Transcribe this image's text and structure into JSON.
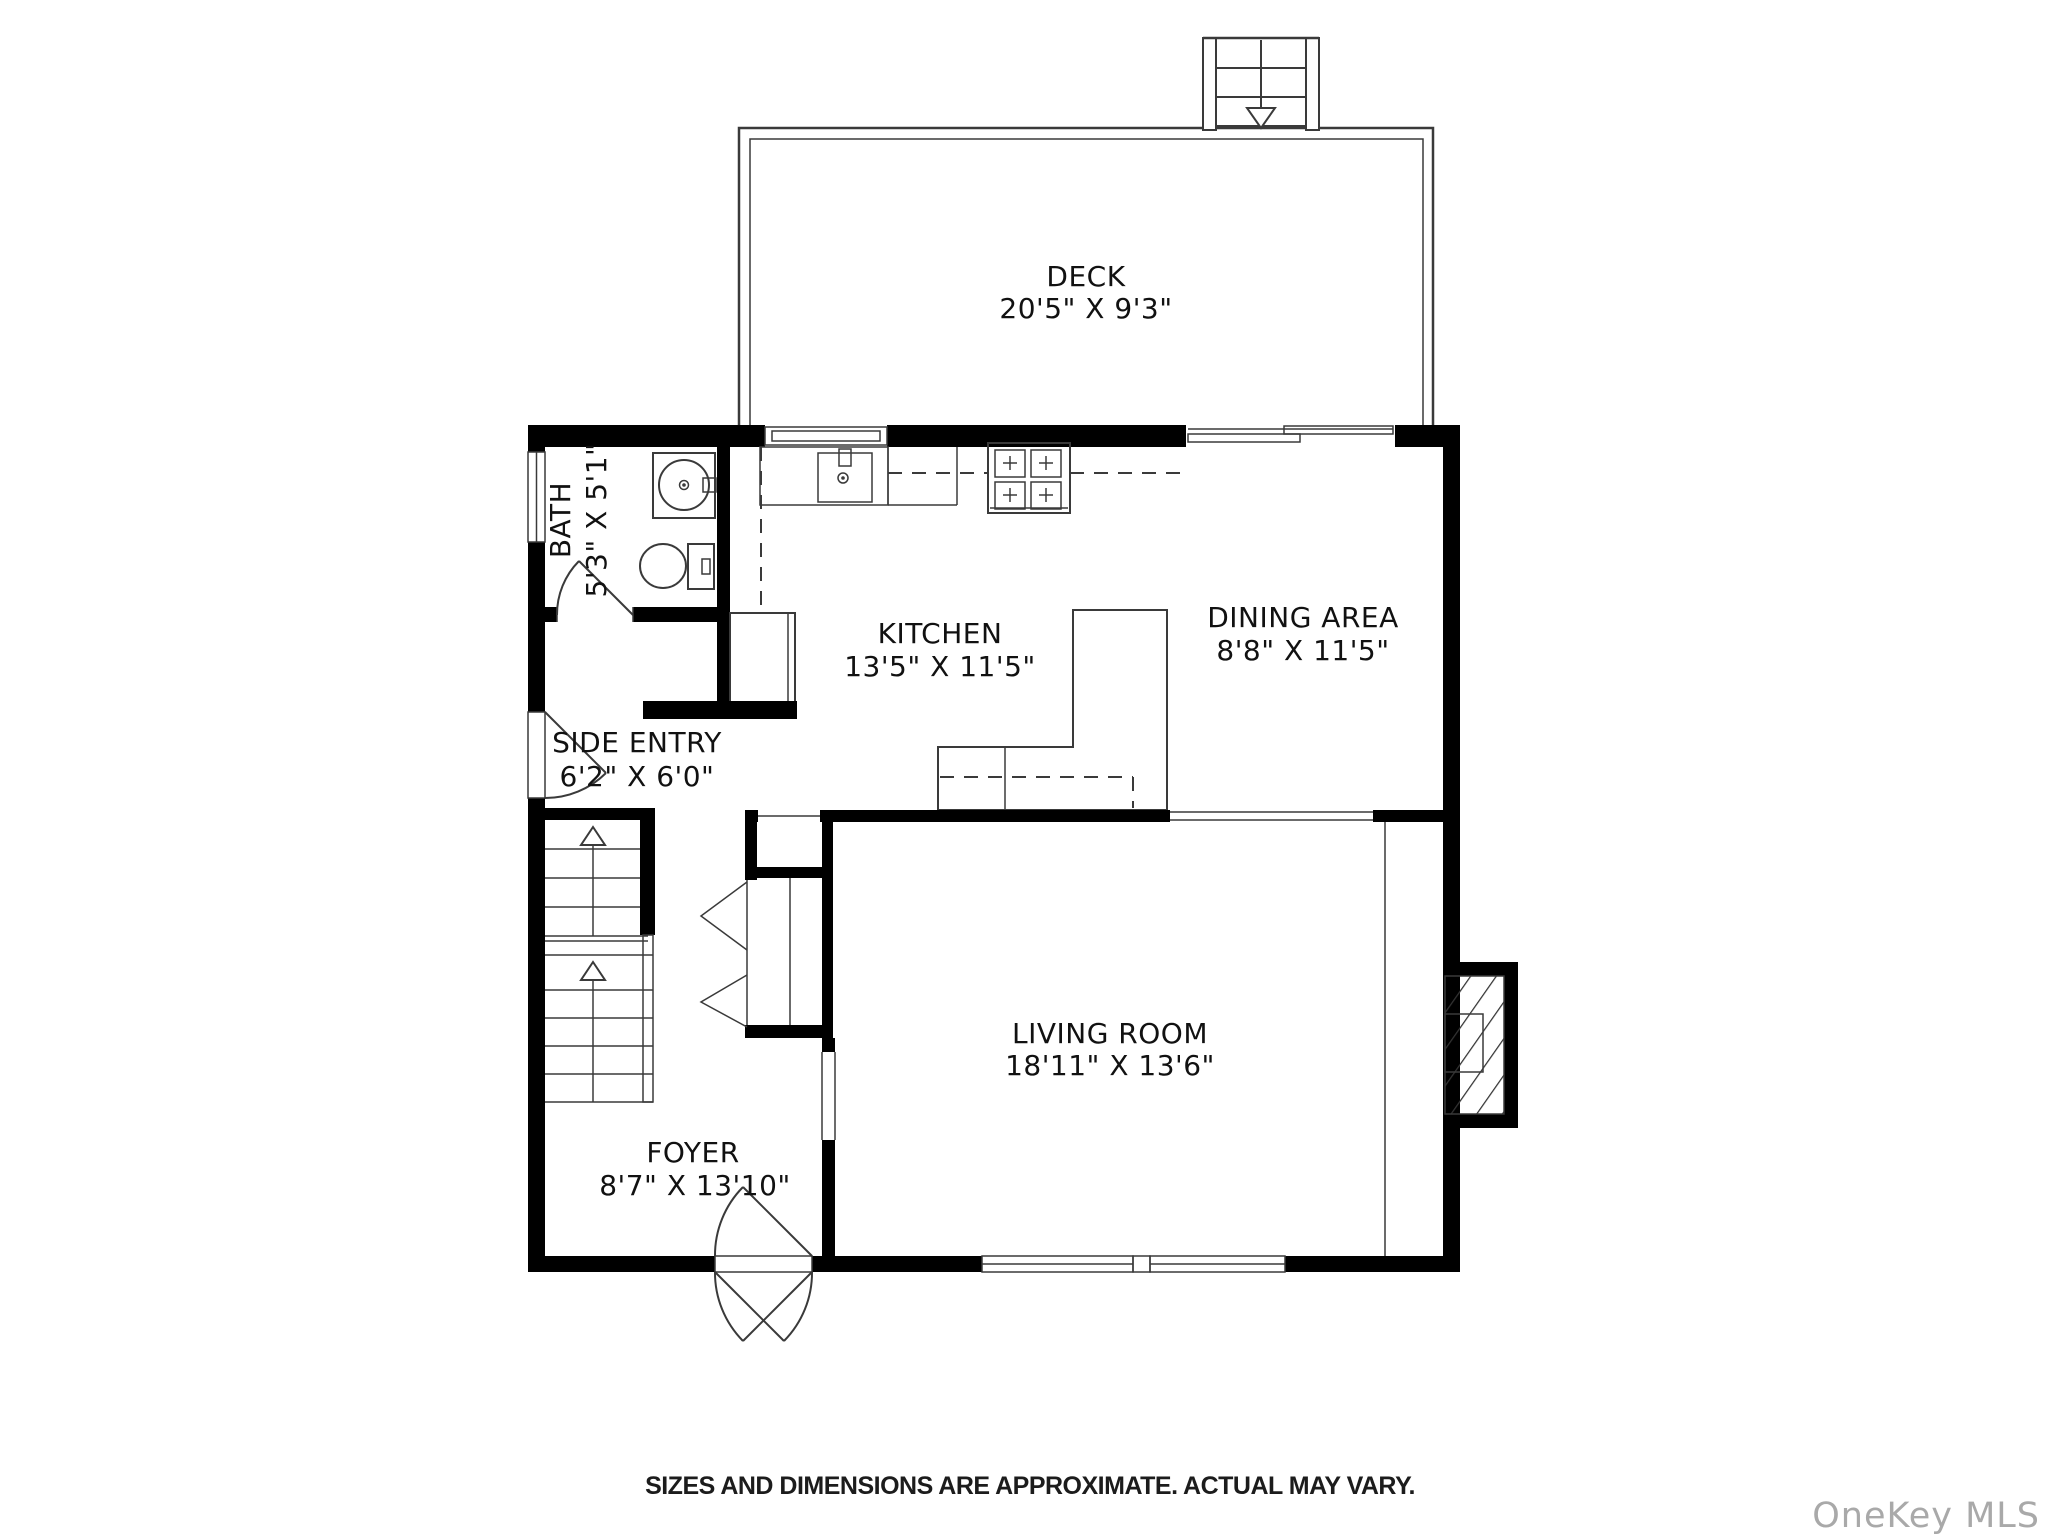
{
  "plan": {
    "rooms": [
      {
        "id": "deck",
        "name": "DECK",
        "dims": "20'5\" X 9'3\""
      },
      {
        "id": "bath",
        "name": "BATH",
        "dims": "5'3\" X 5'1\""
      },
      {
        "id": "kitchen",
        "name": "KITCHEN",
        "dims": "13'5\" X 11'5\""
      },
      {
        "id": "dining-area",
        "name": "DINING AREA",
        "dims": "8'8\" X 11'5\""
      },
      {
        "id": "side-entry",
        "name": "SIDE ENTRY",
        "dims": "6'2\" X 6'0\""
      },
      {
        "id": "living-room",
        "name": "LIVING ROOM",
        "dims": "18'11\" X 13'6\""
      },
      {
        "id": "foyer",
        "name": "FOYER",
        "dims": "8'7\" X 13'10\""
      }
    ],
    "footer": {
      "disclaimer": "SIZES AND DIMENSIONS ARE APPROXIMATE. ACTUAL MAY VARY."
    },
    "watermark": "OneKey MLS",
    "colors": {
      "wall": "#000000",
      "line": "#3a3a3a",
      "text": "#111111",
      "watermark": "#a9a9a9",
      "background": "#ffffff"
    }
  }
}
